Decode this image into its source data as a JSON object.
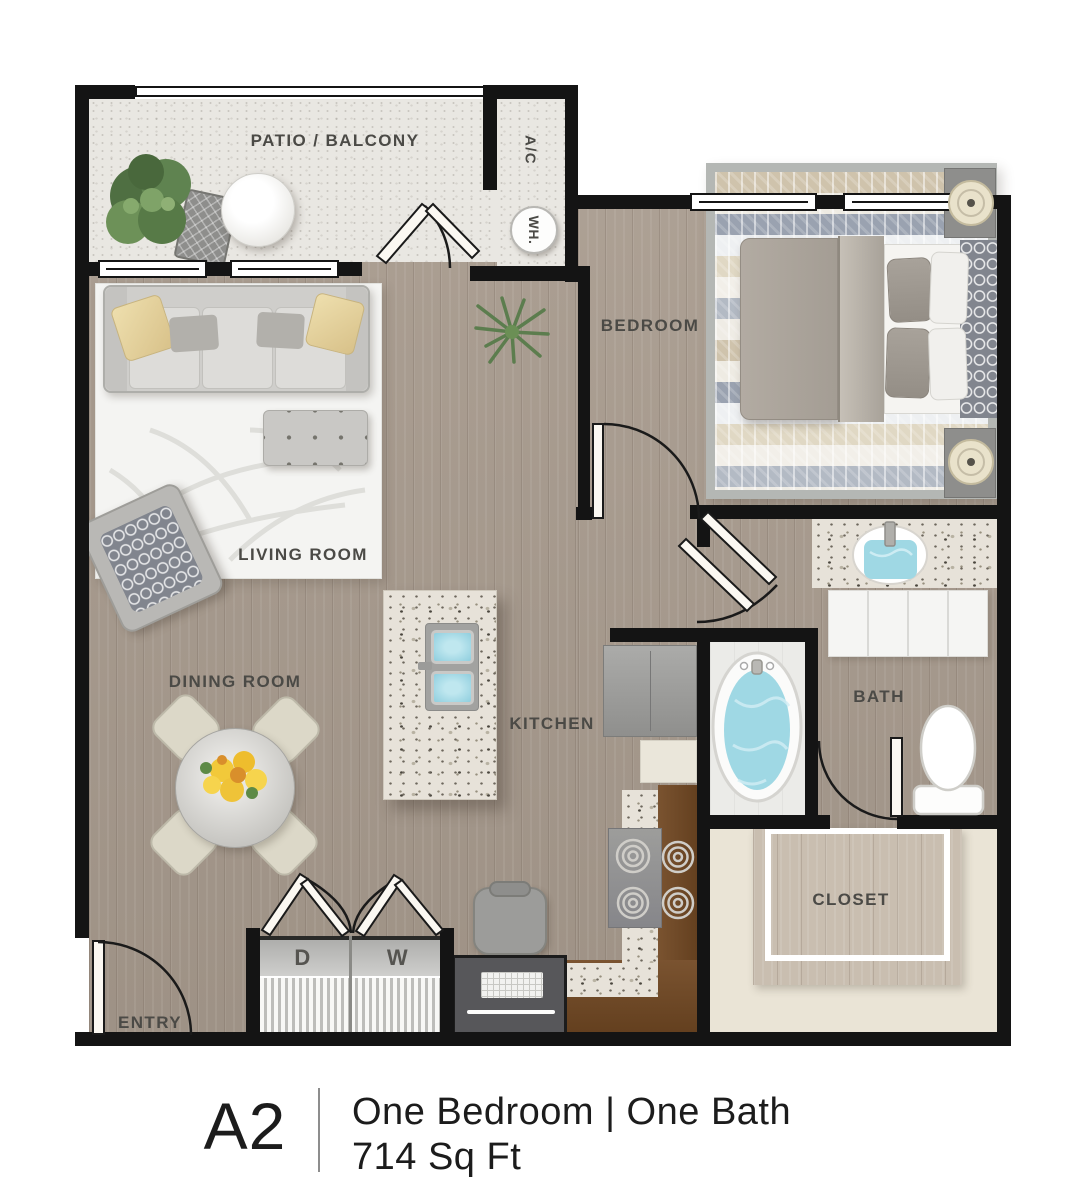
{
  "title": "A2 Floor Plan",
  "rooms": {
    "patio": {
      "label": "PATIO / BALCONY"
    },
    "bedroom": {
      "label": "BEDROOM"
    },
    "living": {
      "label": "LIVING ROOM"
    },
    "dining": {
      "label": "DINING ROOM"
    },
    "kitchen": {
      "label": "KITCHEN"
    },
    "bath": {
      "label": "BATH"
    },
    "closet": {
      "label": "CLOSET"
    },
    "entry": {
      "label": "ENTRY"
    }
  },
  "labels": {
    "ac": "A/C",
    "water_heater": "WH.",
    "dryer": "D",
    "washer": "W"
  },
  "caption": {
    "plan_code": "A2",
    "type": "One Bedroom | One Bath",
    "area": "714 Sq Ft"
  },
  "colors": {
    "wall": "#141414",
    "wood_floor": "#a89b8e",
    "patio_floor": "#e9e7e3",
    "closet_surround": "#eae4d6",
    "counter_brown": "#6f4a28",
    "water_blue": "#9fd8e4",
    "accent_pillow": "#e9d8a6",
    "label_text": "#4b4a46",
    "caption_text": "#1c1c1c"
  }
}
